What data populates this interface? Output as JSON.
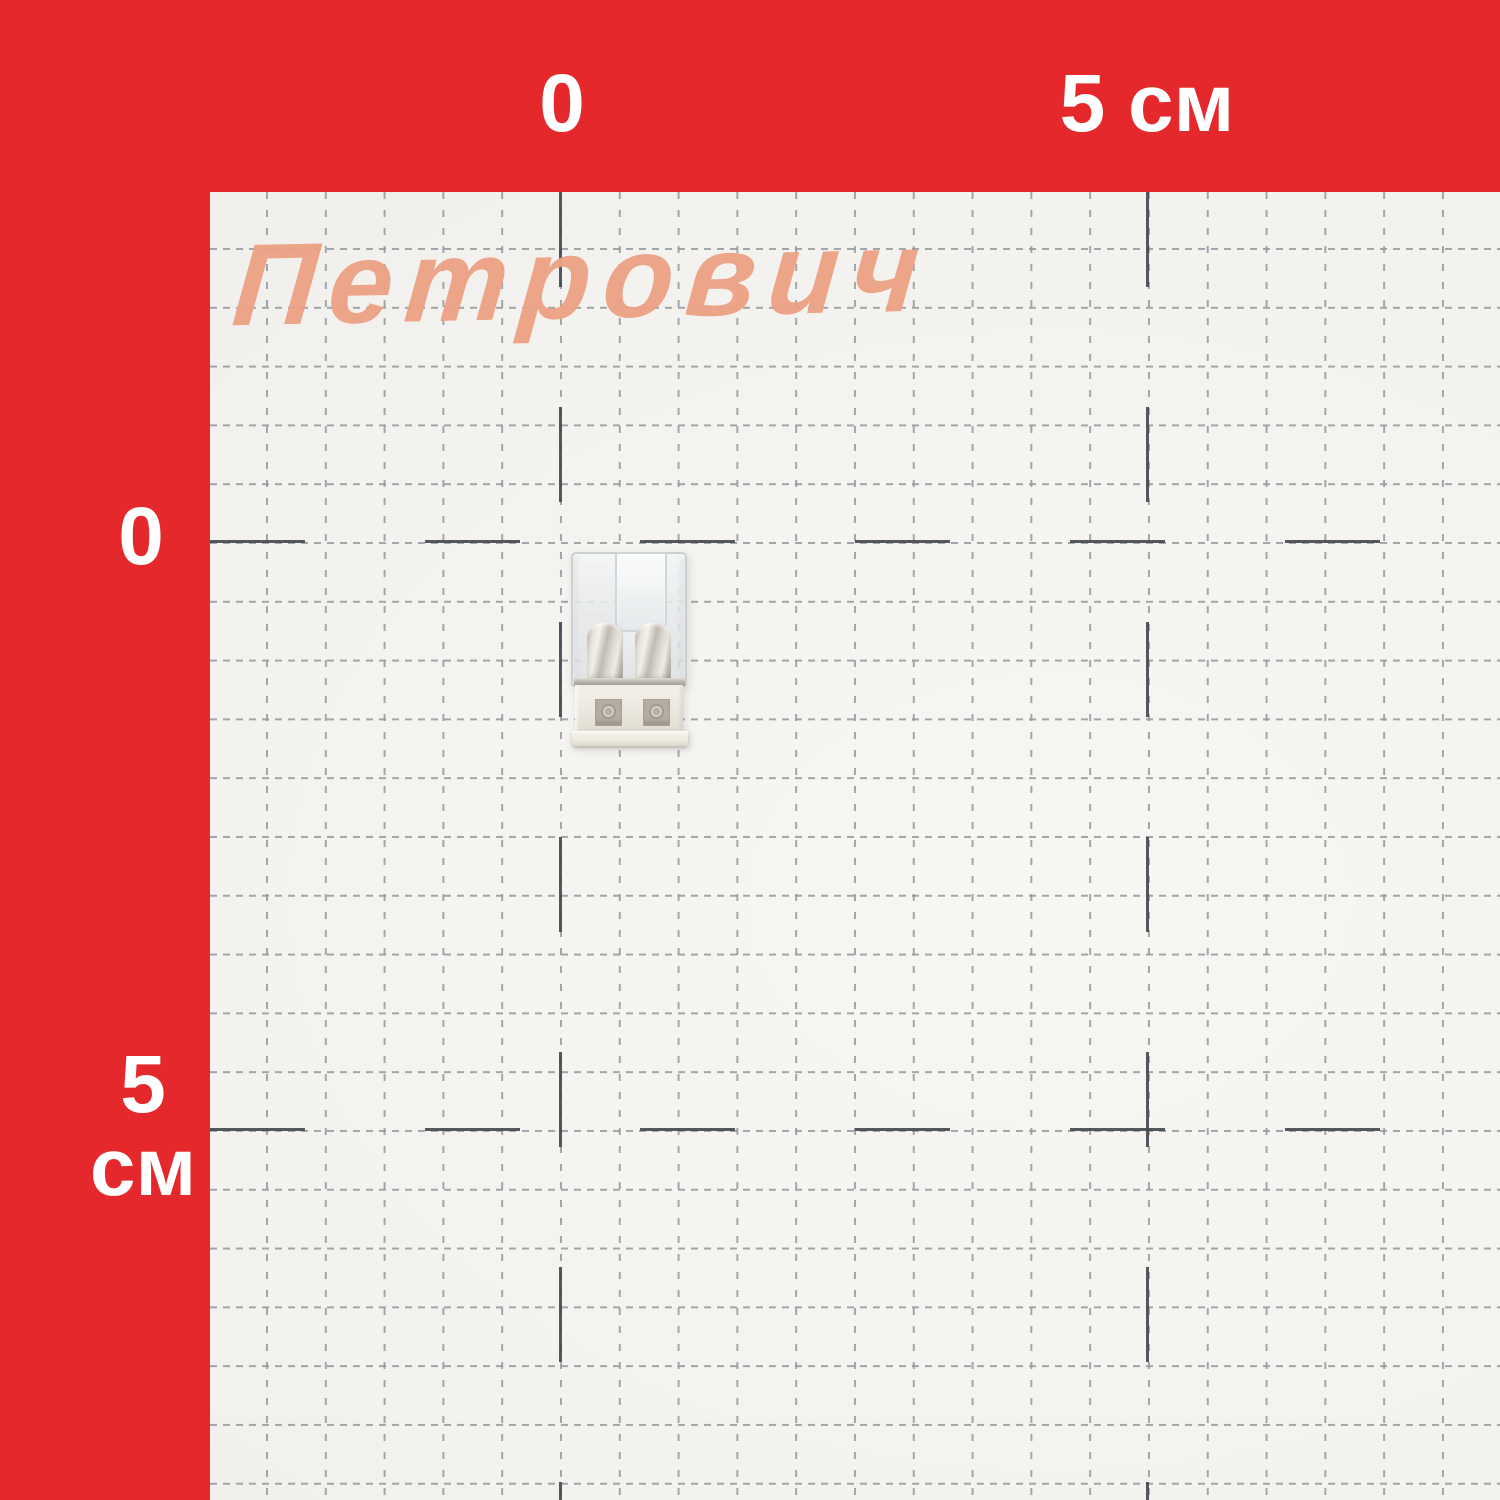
{
  "brand": {
    "logo_text": "Петрович",
    "logo_color": "#eda184"
  },
  "ruler": {
    "band_color": "#e4282b",
    "label_color": "#ffffff",
    "top": {
      "zero": "0",
      "five": "5 см"
    },
    "left": {
      "zero": "0",
      "five": "5",
      "unit": "см"
    }
  },
  "grid": {
    "paper_color": "#f6f4f1",
    "minor_line_color": "#92989d",
    "major_line_color": "#484d51",
    "minor_cell_cm": 0.5,
    "major_cell_cm": 5
  },
  "subject": {
    "description": "2-pole push-in wire connector, transparent housing with white base",
    "poles": 2
  }
}
